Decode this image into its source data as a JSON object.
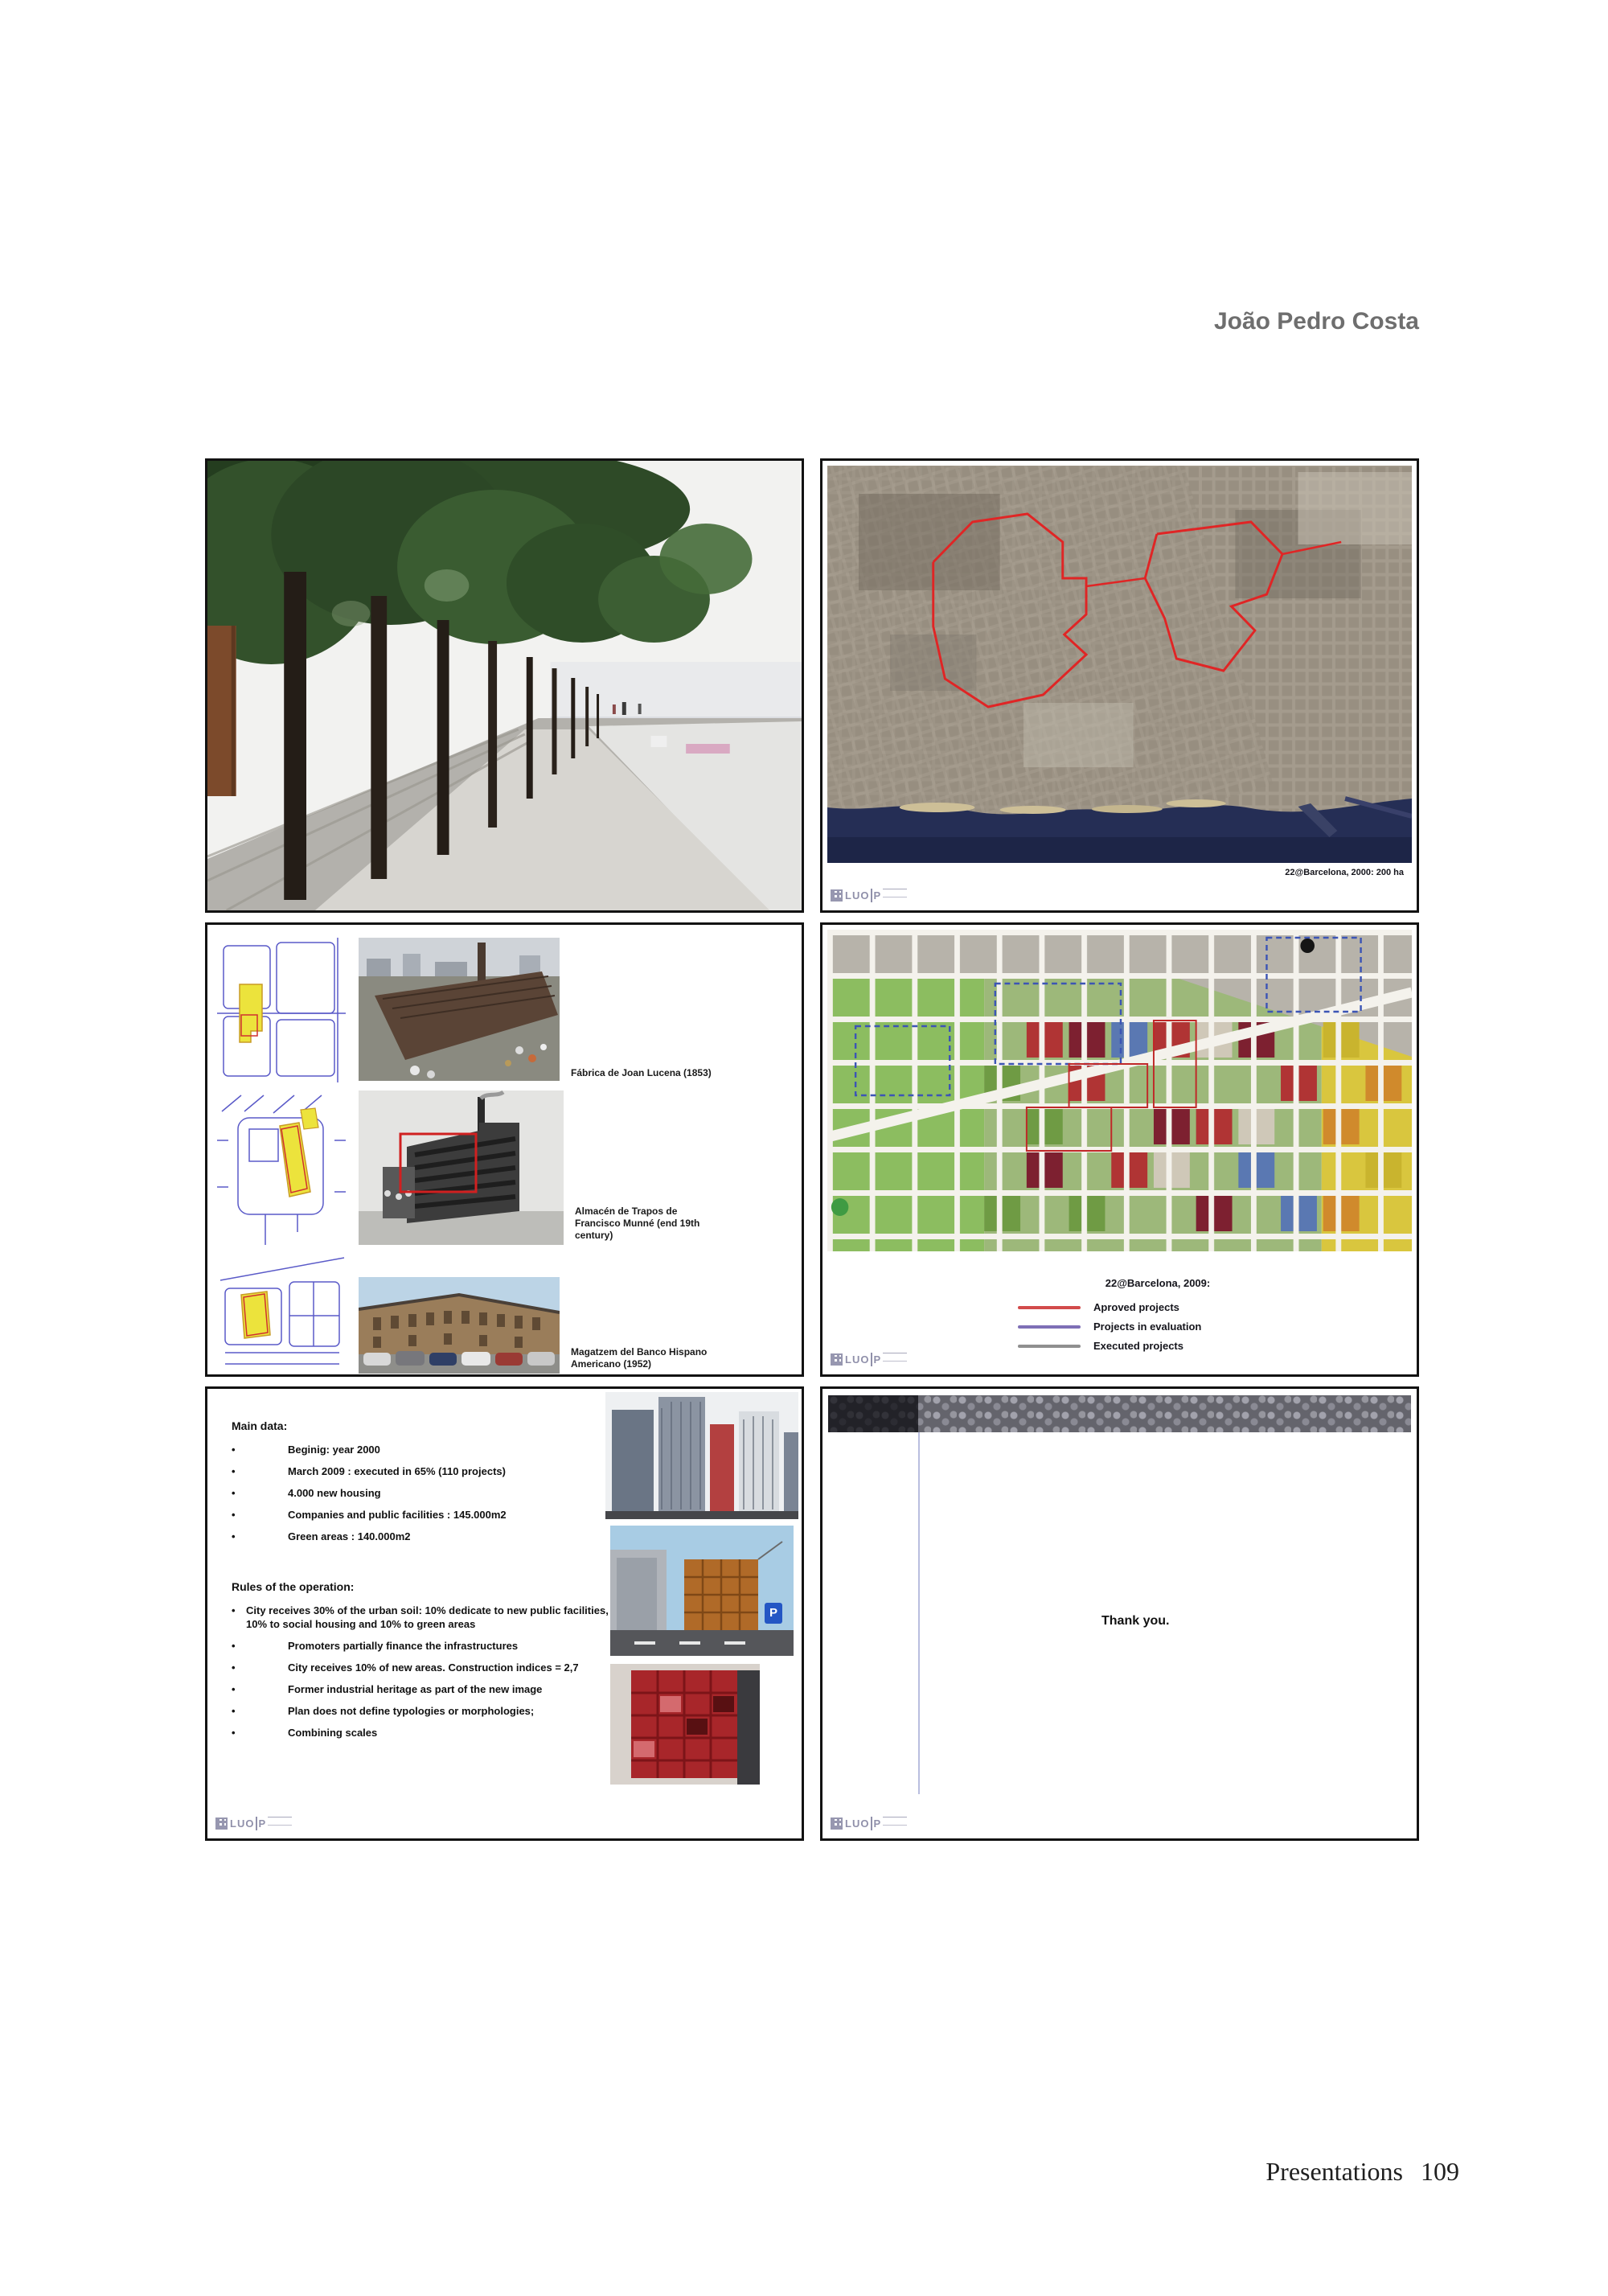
{
  "page": {
    "author": "João Pedro Costa",
    "footer": {
      "label": "Presentations",
      "page_number": "109"
    }
  },
  "logo": {
    "text": "LUO",
    "suffix": "P"
  },
  "glyphs": {
    "bullet": "•"
  },
  "slides": {
    "satellite": {
      "caption": "22@Barcelona, 2000: 200 ha"
    },
    "heritage": {
      "items": [
        {
          "caption": "Fábrica de Joan Lucena (1853)"
        },
        {
          "caption": "Almacén de Trapos de Francisco Munné (end 19th century)"
        },
        {
          "caption": "Magatzem del Banco Hispano Americano (1952)"
        }
      ]
    },
    "plan": {
      "title": "22@Barcelona, 2009:",
      "legend": [
        {
          "label": "Aproved projects",
          "color": "#d24b4b"
        },
        {
          "label": "Projects in evaluation",
          "color": "#7e6fb6"
        },
        {
          "label": "Executed projects",
          "color": "#8f8f8f"
        }
      ]
    },
    "main_data": {
      "heading": "Main data:",
      "bullets": [
        "Beginig: year 2000",
        "March 2009 : executed in 65% (110 projects)",
        "4.000 new housing",
        "Companies and public facilities : 145.000m2",
        "Green areas : 140.000m2"
      ]
    },
    "rules": {
      "heading": "Rules of the operation:",
      "bullets": [
        "City receives 30% of the urban soil: 10% dedicate to new public facilities, 10% to social housing and 10% to green areas",
        "Promoters partially finance the infrastructures",
        "City receives 10% of new areas. Construction indices = 2,7",
        "Former industrial heritage as part of the new image",
        "Plan does not define typologies or morphologies;",
        "Combining scales"
      ]
    },
    "street_photos": {
      "parking_sign": "P"
    },
    "thanks": {
      "message": "Thank you."
    }
  }
}
